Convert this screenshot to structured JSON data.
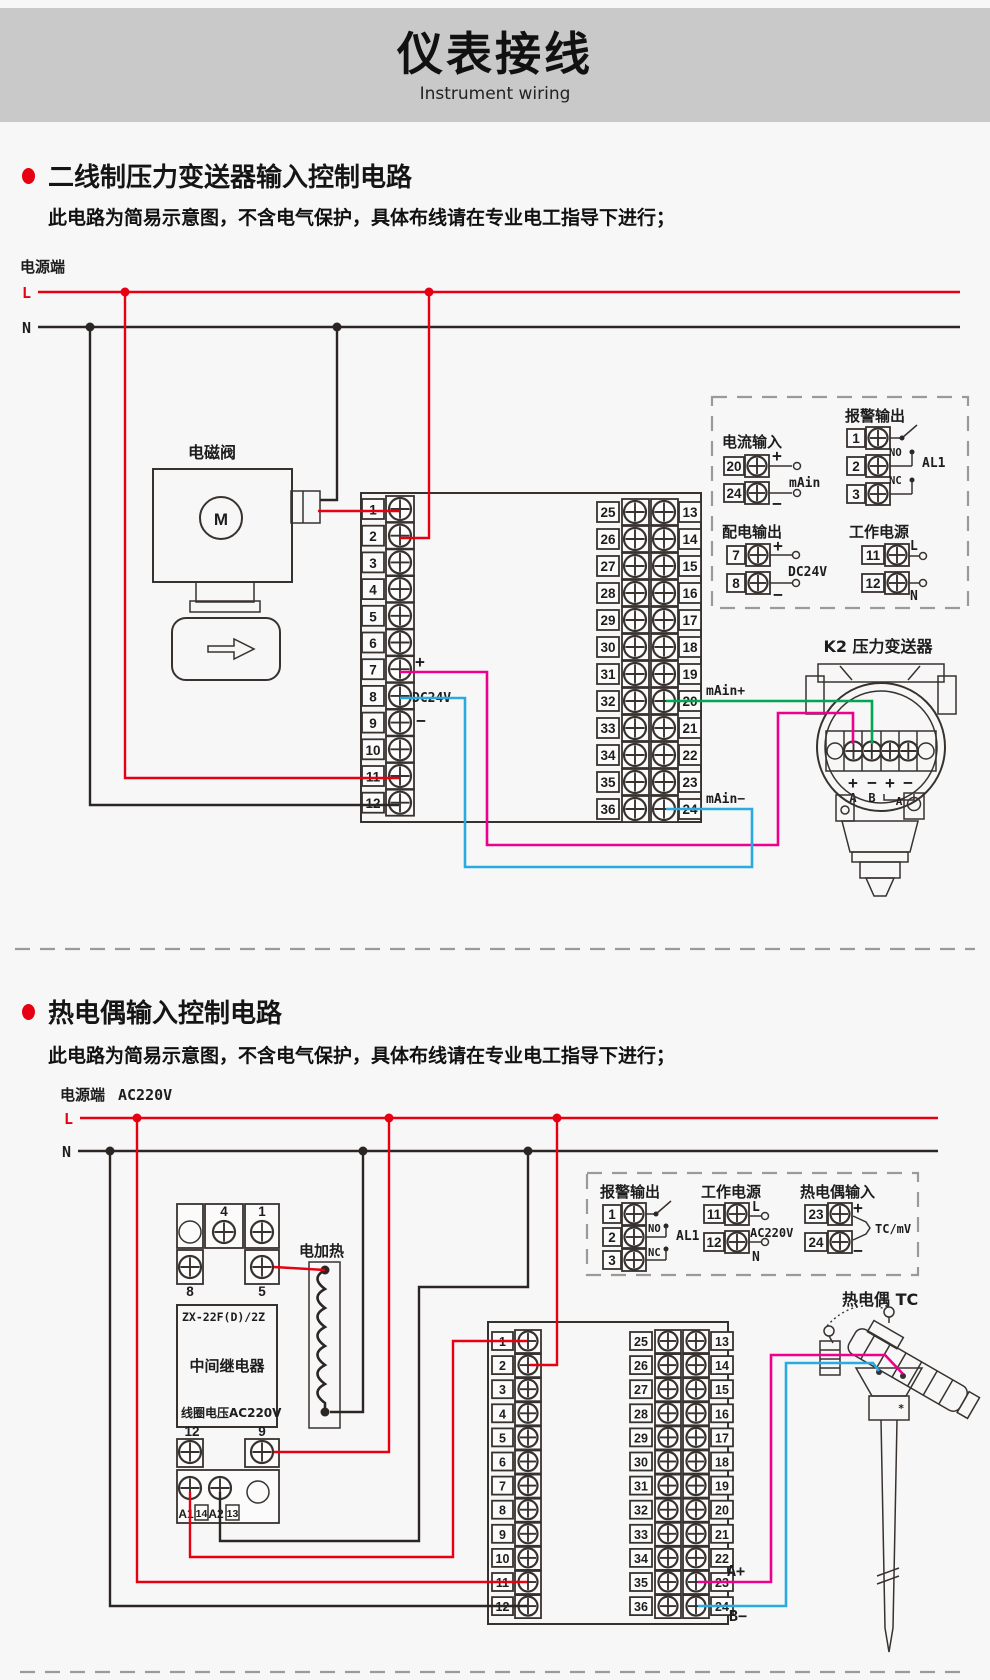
{
  "header": {
    "title": "仪表接线",
    "subtitle": "Instrument wiring"
  },
  "colors": {
    "red": "#e60012",
    "green": "#00a651",
    "magenta": "#ec008c",
    "blue": "#29abe2",
    "banner": "#c9c9c9"
  },
  "s1": {
    "title": "二线制压力变送器输入控制电路",
    "note": "此电路为简易示意图，不含电气保护，具体布线请在专业电工指导下进行；",
    "power_label": "电源端",
    "l": "L",
    "n": "N",
    "solenoid": "电磁阀",
    "motor": "M",
    "plus": "+",
    "minus": "−",
    "dc24v": "DC24V",
    "main_plus": "mAin+",
    "main_minus": "mAin−",
    "termL": [
      "1",
      "2",
      "3",
      "4",
      "5",
      "6",
      "7",
      "8",
      "9",
      "10",
      "11",
      "12"
    ],
    "rows": [
      {
        "l": "25",
        "r": "13"
      },
      {
        "l": "26",
        "r": "14"
      },
      {
        "l": "27",
        "r": "15"
      },
      {
        "l": "28",
        "r": "16"
      },
      {
        "l": "29",
        "r": "17"
      },
      {
        "l": "30",
        "r": "18"
      },
      {
        "l": "31",
        "r": "19"
      },
      {
        "l": "32",
        "r": "20"
      },
      {
        "l": "33",
        "r": "21"
      },
      {
        "l": "34",
        "r": "22"
      },
      {
        "l": "35",
        "r": "23"
      },
      {
        "l": "36",
        "r": "24"
      }
    ],
    "box": {
      "current_title": "电流输入",
      "cur_t1": "20",
      "cur_t2": "24",
      "cur_plus": "+",
      "cur_minus": "−",
      "cur_label": "mAin",
      "alarm_title": "报警输出",
      "alarm_t1": "1",
      "alarm_t2": "2",
      "alarm_t3": "3",
      "no": "NO",
      "nc": "NC",
      "al1": "AL1",
      "dist_title": "配电输出",
      "dist_t1": "7",
      "dist_t2": "8",
      "dist_plus": "+",
      "dist_minus": "−",
      "dist_label": "DC24V",
      "work_title": "工作电源",
      "work_t1": "11",
      "work_t2": "12",
      "work_l": "L",
      "work_n": "N"
    },
    "tx": {
      "label": "K2 压力变送器",
      "p1": "+",
      "m1": "−",
      "p2": "+",
      "m2": "−",
      "a": "A",
      "b": "B",
      "a2": "A"
    }
  },
  "s2": {
    "title": "热电偶输入控制电路",
    "note": "此电路为简易示意图，不含电气保护，具体布线请在专业电工指导下进行；",
    "power_label": "电源端",
    "ac": "AC220V",
    "l": "L",
    "n": "N",
    "heater": "电加热",
    "relay": {
      "t4": "4",
      "t1": "1",
      "t8": "8",
      "t5": "5",
      "model": "ZX-22F(D)/2Z",
      "name": "中间继电器",
      "coil": "线圈电压AC220V",
      "t12": "12",
      "t9": "9",
      "a1": "A1",
      "t14": "14",
      "a2": "A2",
      "t13": "13"
    },
    "termL": [
      "1",
      "2",
      "3",
      "4",
      "5",
      "6",
      "7",
      "8",
      "9",
      "10",
      "11",
      "12"
    ],
    "rows": [
      {
        "l": "25",
        "r": "13"
      },
      {
        "l": "26",
        "r": "14"
      },
      {
        "l": "27",
        "r": "15"
      },
      {
        "l": "28",
        "r": "16"
      },
      {
        "l": "29",
        "r": "17"
      },
      {
        "l": "30",
        "r": "18"
      },
      {
        "l": "31",
        "r": "19"
      },
      {
        "l": "32",
        "r": "20"
      },
      {
        "l": "33",
        "r": "21"
      },
      {
        "l": "34",
        "r": "22"
      },
      {
        "l": "35",
        "r": "23"
      },
      {
        "l": "36",
        "r": "24"
      }
    ],
    "box": {
      "alarm_title": "报警输出",
      "alarm_t1": "1",
      "alarm_t2": "2",
      "alarm_t3": "3",
      "no": "NO",
      "nc": "NC",
      "al1": "AL1",
      "work_title": "工作电源",
      "work_t1": "11",
      "work_t2": "12",
      "work_l": "L",
      "work_ac": "AC220V",
      "work_n": "N",
      "tc_title": "热电偶输入",
      "tc_t1": "23",
      "tc_t2": "24",
      "tc_plus": "+",
      "tc_minus": "−",
      "tc_label": "TC/mV"
    },
    "tc_label": "热电偶 TC",
    "a_plus": "A+",
    "b_minus": "B−"
  }
}
